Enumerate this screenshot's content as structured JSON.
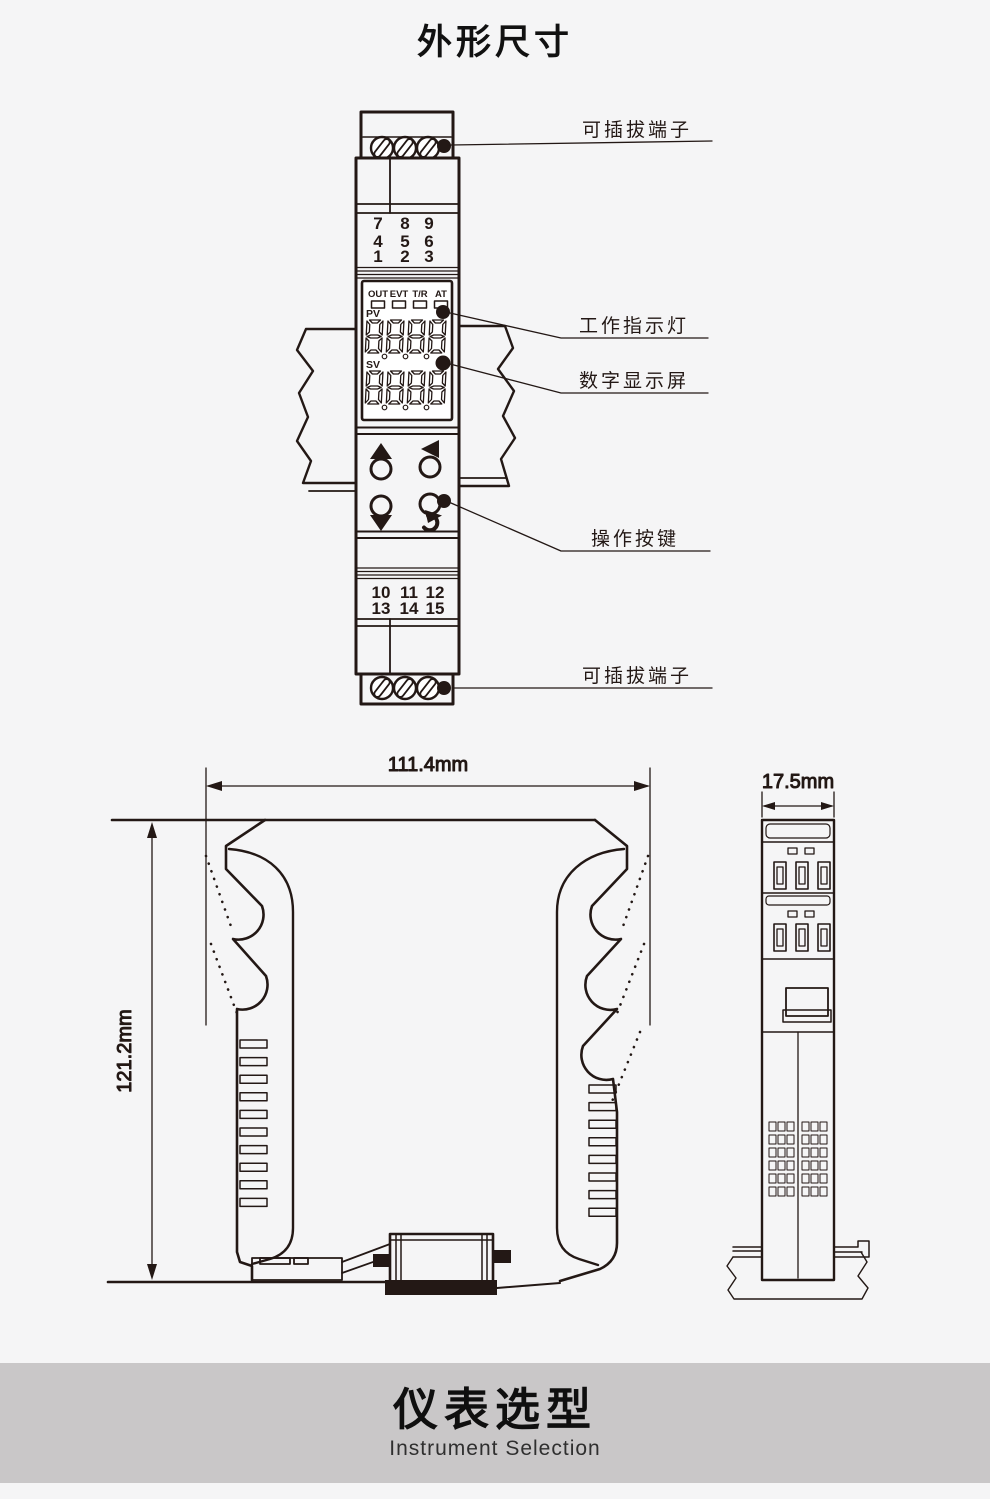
{
  "page": {
    "title": "外形尺寸"
  },
  "banner": {
    "title": "仪表选型",
    "subtitle": "Instrument Selection"
  },
  "front_view": {
    "labels": {
      "pluggable_terminal_top": "可插拔端子",
      "work_indicator": "工作指示灯",
      "digital_display": "数字显示屏",
      "operation_buttons": "操作按键",
      "pluggable_terminal_bottom": "可插拔端子"
    },
    "terminals_top": {
      "rows": [
        [
          "7",
          "8",
          "9"
        ],
        [
          "4",
          "5",
          "6"
        ],
        [
          "1",
          "2",
          "3"
        ]
      ],
      "red_numbers": [
        "7",
        "8"
      ]
    },
    "terminals_bottom": {
      "rows": [
        [
          "10",
          "11",
          "12"
        ],
        [
          "13",
          "14",
          "15"
        ]
      ]
    },
    "display": {
      "status_labels": [
        "OUT",
        "EVT",
        "T/R",
        "AT"
      ],
      "pv_label": "PV",
      "sv_label": "SV",
      "pv_value": "8888",
      "sv_value": "8888"
    },
    "colors": {
      "red": "#e60012",
      "line": "#231815"
    }
  },
  "dimensions": {
    "width": "111.4mm",
    "height": "121.2mm",
    "depth": "17.5mm"
  }
}
